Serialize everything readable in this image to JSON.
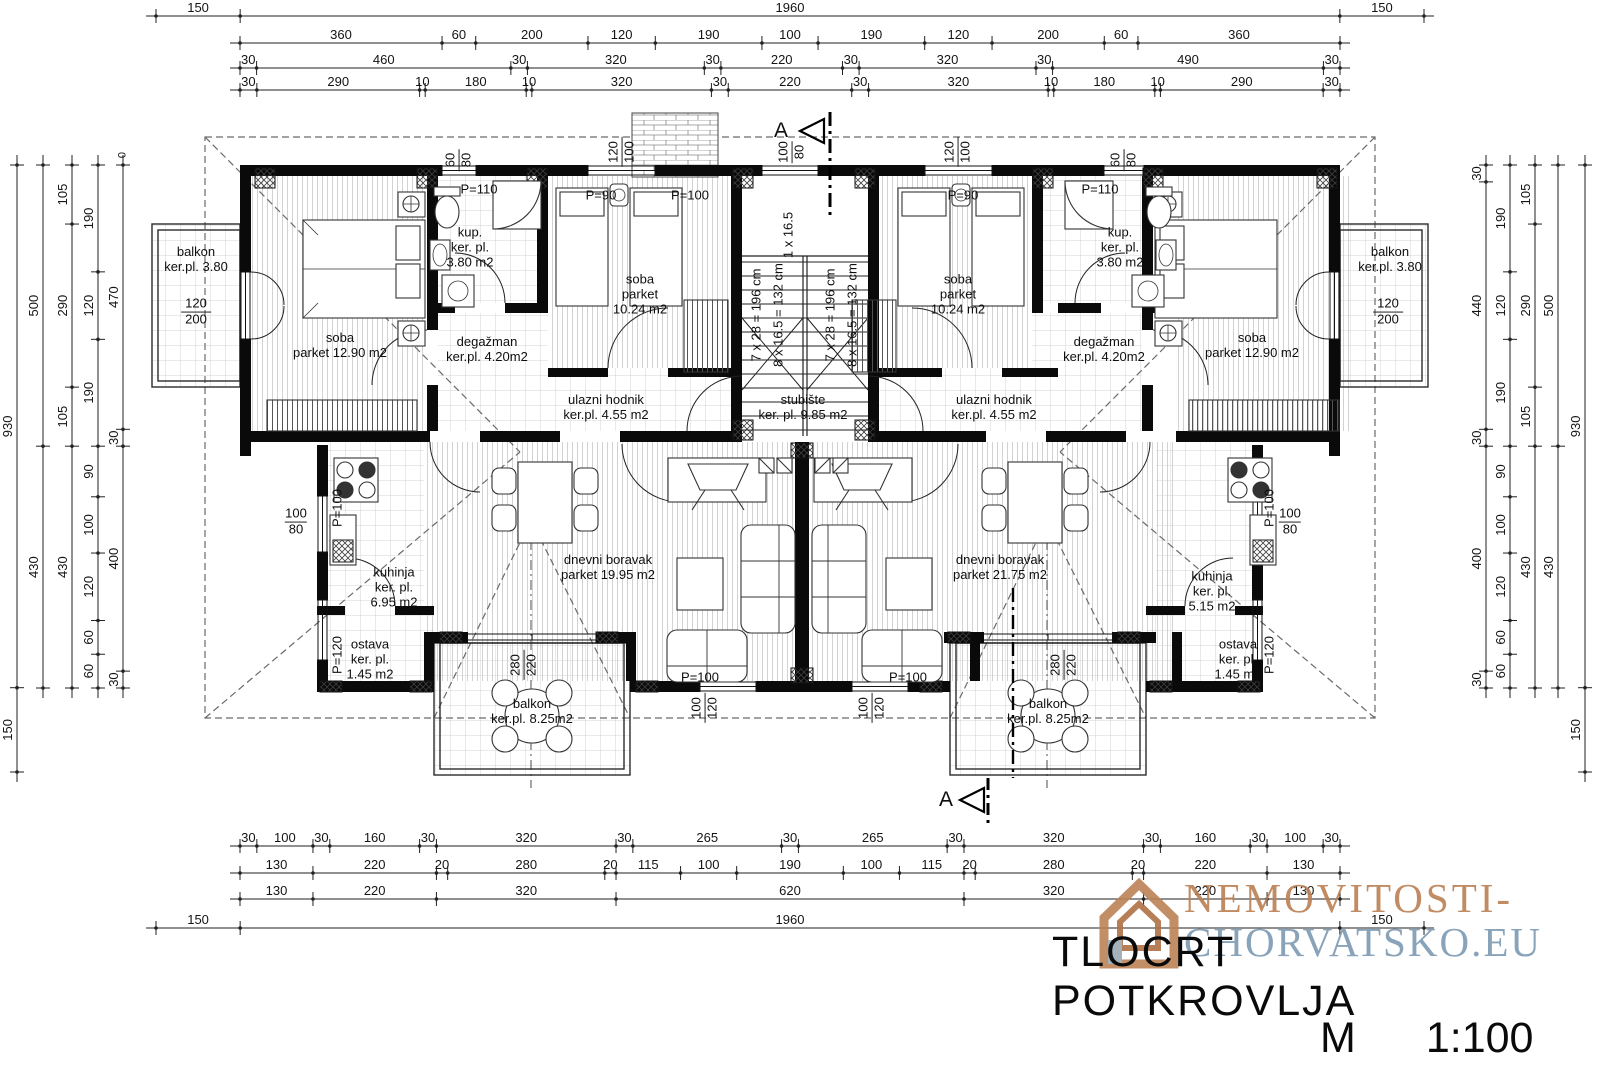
{
  "title_block": {
    "title": "TLOCRT POTKROVLJA",
    "scale_letter": "M",
    "scale_ratio": "1:100"
  },
  "watermark": {
    "line1": "NEMOVITOSTI-",
    "line2": "CHORVATSKO.EU",
    "color1": "#bc8256",
    "color2": "#7f9cb5",
    "house_icon_color": "#bc8256"
  },
  "section_marker_letter": "A",
  "datum_label": "0",
  "dims": {
    "horizontal": [
      {
        "id": "top-row-1",
        "y": 16,
        "x1": 156,
        "x2": 1424,
        "values": [
          150,
          1960,
          150
        ]
      },
      {
        "id": "top-row-2",
        "y": 43,
        "x1": 240,
        "x2": 1340,
        "values": [
          360,
          60,
          200,
          120,
          190,
          100,
          190,
          120,
          200,
          60,
          360
        ]
      },
      {
        "id": "top-row-3",
        "y": 68,
        "x1": 240,
        "x2": 1340,
        "values": [
          30,
          460,
          30,
          320,
          30,
          220,
          30,
          320,
          30,
          490,
          30
        ]
      },
      {
        "id": "top-row-4",
        "y": 90,
        "x1": 240,
        "x2": 1340,
        "values": [
          30,
          290,
          10,
          180,
          10,
          320,
          30,
          220,
          30,
          320,
          10,
          180,
          10,
          290,
          30
        ]
      },
      {
        "id": "bottom-row-1",
        "y": 846,
        "x1": 240,
        "x2": 1340,
        "values": [
          30,
          100,
          30,
          160,
          30,
          320,
          30,
          265,
          30,
          265,
          30,
          320,
          30,
          160,
          30,
          100,
          30
        ]
      },
      {
        "id": "bottom-row-2",
        "y": 873,
        "x1": 240,
        "x2": 1340,
        "values": [
          130,
          220,
          20,
          280,
          20,
          115,
          100,
          190,
          100,
          115,
          20,
          280,
          20,
          220,
          130
        ]
      },
      {
        "id": "bottom-row-3",
        "y": 899,
        "x1": 240,
        "x2": 1340,
        "values": [
          130,
          220,
          320,
          620,
          320,
          220,
          130
        ]
      },
      {
        "id": "bottom-row-4",
        "y": 928,
        "x1": 156,
        "x2": 1424,
        "values": [
          150,
          1960,
          150
        ]
      }
    ],
    "vertical": [
      {
        "id": "left-col-1",
        "x": 17,
        "y1": 165,
        "y2": 772,
        "values": [
          930,
          150
        ]
      },
      {
        "id": "left-col-2",
        "x": 43,
        "y1": 165,
        "y2": 688,
        "values": [
          500,
          430
        ]
      },
      {
        "id": "left-col-3",
        "x": 72,
        "y1": 165,
        "y2": 688,
        "values": [
          105,
          290,
          105,
          430
        ]
      },
      {
        "id": "left-col-4",
        "x": 98,
        "y1": 165,
        "y2": 688,
        "values": [
          190,
          120,
          190,
          90,
          100,
          120,
          60,
          60
        ]
      },
      {
        "id": "left-col-5",
        "x": 123,
        "y1": 165,
        "y2": 688,
        "values": [
          470,
          30,
          400,
          30
        ]
      },
      {
        "id": "right-col-1",
        "x": 1486,
        "y1": 165,
        "y2": 688,
        "values": [
          30,
          440,
          30,
          400,
          30
        ]
      },
      {
        "id": "right-col-2",
        "x": 1510,
        "y1": 165,
        "y2": 688,
        "values": [
          190,
          120,
          190,
          90,
          100,
          120,
          60,
          60
        ]
      },
      {
        "id": "right-col-3",
        "x": 1535,
        "y1": 165,
        "y2": 688,
        "values": [
          105,
          290,
          105,
          430
        ]
      },
      {
        "id": "right-col-4",
        "x": 1558,
        "y1": 165,
        "y2": 688,
        "values": [
          500,
          430
        ]
      },
      {
        "id": "right-col-5",
        "x": 1585,
        "y1": 165,
        "y2": 772,
        "values": [
          930,
          150
        ]
      }
    ]
  },
  "labels": [
    {
      "id": "room-balkon-left",
      "x": 196,
      "y": 260,
      "cls": "",
      "lines": [
        "balkon",
        "ker.pl. 3.80"
      ]
    },
    {
      "id": "room-soba-left",
      "x": 340,
      "y": 346,
      "cls": "",
      "lines": [
        "soba",
        "parket 12.90 m2"
      ]
    },
    {
      "id": "room-kup-left",
      "x": 470,
      "y": 248,
      "cls": "",
      "lines": [
        "kup.",
        "ker. pl.",
        "3.80 m2"
      ]
    },
    {
      "id": "room-degazman-left",
      "x": 487,
      "y": 350,
      "cls": "",
      "lines": [
        "degažman",
        "ker.pl. 4.20m2"
      ]
    },
    {
      "id": "room-soba-small-left",
      "x": 640,
      "y": 295,
      "cls": "",
      "lines": [
        "soba",
        "parket",
        "10.24 m2"
      ]
    },
    {
      "id": "room-ulazni-left",
      "x": 606,
      "y": 408,
      "cls": "",
      "lines": [
        "ulazni hodnik",
        "ker.pl. 4.55 m2"
      ]
    },
    {
      "id": "room-stubiste",
      "x": 803,
      "y": 408,
      "cls": "",
      "lines": [
        "stubište",
        "ker. pl. 9.85 m2"
      ]
    },
    {
      "id": "room-ulazni-right",
      "x": 994,
      "y": 408,
      "cls": "",
      "lines": [
        "ulazni hodnik",
        "ker.pl. 4.55 m2"
      ]
    },
    {
      "id": "room-soba-small-right",
      "x": 958,
      "y": 295,
      "cls": "",
      "lines": [
        "soba",
        "parket",
        "10.24 m2"
      ]
    },
    {
      "id": "room-kup-right",
      "x": 1120,
      "y": 248,
      "cls": "",
      "lines": [
        "kup.",
        "ker. pl.",
        "3.80 m2"
      ]
    },
    {
      "id": "room-degazman-right",
      "x": 1104,
      "y": 350,
      "cls": "",
      "lines": [
        "degažman",
        "ker.pl. 4.20m2"
      ]
    },
    {
      "id": "room-soba-right",
      "x": 1252,
      "y": 346,
      "cls": "",
      "lines": [
        "soba",
        "parket 12.90 m2"
      ]
    },
    {
      "id": "room-balkon-right",
      "x": 1390,
      "y": 260,
      "cls": "",
      "lines": [
        "balkon",
        "ker.pl. 3.80"
      ]
    },
    {
      "id": "room-kuhinja-left",
      "x": 394,
      "y": 588,
      "cls": "",
      "lines": [
        "kuhinja",
        "ker. pl.",
        "6.95 m2"
      ]
    },
    {
      "id": "room-ostava-left",
      "x": 370,
      "y": 660,
      "cls": "",
      "lines": [
        "ostava",
        "ker. pl.",
        "1.45 m2"
      ]
    },
    {
      "id": "room-dnevni-left",
      "x": 608,
      "y": 568,
      "cls": "",
      "lines": [
        "dnevni boravak",
        "parket 19.95 m2"
      ]
    },
    {
      "id": "room-balkon-bottom-left",
      "x": 532,
      "y": 712,
      "cls": "",
      "lines": [
        "balkon",
        "ker.pl. 8.25m2"
      ]
    },
    {
      "id": "room-dnevni-right",
      "x": 1000,
      "y": 568,
      "cls": "",
      "lines": [
        "dnevni boravak",
        "parket 21.75 m2"
      ]
    },
    {
      "id": "room-kuhinja-right",
      "x": 1212,
      "y": 592,
      "cls": "",
      "lines": [
        "kuhinja",
        "ker. pl.",
        "5.15 m2"
      ]
    },
    {
      "id": "room-ostava-right",
      "x": 1238,
      "y": 660,
      "cls": "",
      "lines": [
        "ostava",
        "ker. pl.",
        "1.45 m2"
      ]
    },
    {
      "id": "room-balkon-bottom-right",
      "x": 1048,
      "y": 712,
      "cls": "",
      "lines": [
        "balkon",
        "ker.pl. 8.25m2"
      ]
    },
    {
      "id": "window-p110-left",
      "x": 479,
      "y": 190,
      "cls": "",
      "lines": [
        "P=110"
      ]
    },
    {
      "id": "window-p90-left",
      "x": 601,
      "y": 196,
      "cls": "",
      "lines": [
        "P=90"
      ]
    },
    {
      "id": "window-p100-top",
      "x": 690,
      "y": 196,
      "cls": "",
      "lines": [
        "P=100"
      ]
    },
    {
      "id": "window-p90-right",
      "x": 963,
      "y": 196,
      "cls": "",
      "lines": [
        "P=90"
      ]
    },
    {
      "id": "window-p110-right",
      "x": 1100,
      "y": 190,
      "cls": "",
      "lines": [
        "P=110"
      ]
    },
    {
      "id": "door-p100-bottom-left",
      "x": 700,
      "y": 678,
      "cls": "",
      "lines": [
        "P=100"
      ]
    },
    {
      "id": "door-p100-bottom-right",
      "x": 908,
      "y": 678,
      "cls": "",
      "lines": [
        "P=100"
      ]
    },
    {
      "id": "datum-zero",
      "x": 123,
      "y": 155,
      "cls": "rot small",
      "lines": [
        "0"
      ]
    },
    {
      "id": "stair-first-step",
      "x": 789,
      "y": 235,
      "cls": "rot",
      "lines": [
        "1 x 16.5"
      ]
    },
    {
      "id": "stair-flight1-run",
      "x": 757,
      "y": 315,
      "cls": "rot",
      "lines": [
        "7 x 28 = 196 cm"
      ]
    },
    {
      "id": "stair-flight1-rise",
      "x": 779,
      "y": 315,
      "cls": "rot",
      "lines": [
        "8 x 16.5 = 132 cm"
      ]
    },
    {
      "id": "stair-flight2-run",
      "x": 831,
      "y": 315,
      "cls": "rot",
      "lines": [
        "7 x 28 = 196 cm"
      ]
    },
    {
      "id": "stair-flight2-rise",
      "x": 853,
      "y": 315,
      "cls": "rot",
      "lines": [
        "8 x 16.5 = 132 cm"
      ]
    },
    {
      "id": "window-pv100-left",
      "x": 338,
      "y": 508,
      "cls": "rot",
      "lines": [
        "P=100"
      ]
    },
    {
      "id": "window-pv120-left",
      "x": 338,
      "y": 655,
      "cls": "rot",
      "lines": [
        "P=120"
      ]
    },
    {
      "id": "window-pv100-right",
      "x": 1270,
      "y": 508,
      "cls": "rot",
      "lines": [
        "P=100"
      ]
    },
    {
      "id": "window-pv120-right",
      "x": 1270,
      "y": 655,
      "cls": "rot",
      "lines": [
        "P=120"
      ]
    },
    {
      "id": "balcony-door-size-left",
      "x": 196,
      "y": 312,
      "cls": "stacked",
      "lines": [
        "120",
        "200"
      ]
    },
    {
      "id": "balcony-door-size-right",
      "x": 1388,
      "y": 312,
      "cls": "stacked",
      "lines": [
        "120",
        "200"
      ]
    },
    {
      "id": "kitchen-window-size-left",
      "x": 296,
      "y": 522,
      "cls": "stacked",
      "lines": [
        "100",
        "80"
      ]
    },
    {
      "id": "kitchen-window-size-right",
      "x": 1290,
      "y": 522,
      "cls": "stacked",
      "lines": [
        "100",
        "80"
      ]
    },
    {
      "id": "vent-window-size-left",
      "x": 459,
      "y": 160,
      "cls": "stacked rot",
      "lines": [
        "60",
        "80"
      ]
    },
    {
      "id": "soba-window-size-left",
      "x": 622,
      "y": 152,
      "cls": "stacked rot",
      "lines": [
        "120",
        "100"
      ]
    },
    {
      "id": "stair-window-size",
      "x": 792,
      "y": 152,
      "cls": "stacked rot",
      "lines": [
        "100",
        "80"
      ]
    },
    {
      "id": "soba-window-size-right",
      "x": 958,
      "y": 152,
      "cls": "stacked rot",
      "lines": [
        "120",
        "100"
      ]
    },
    {
      "id": "vent-window-size-right",
      "x": 1124,
      "y": 160,
      "cls": "stacked rot",
      "lines": [
        "60",
        "80"
      ]
    },
    {
      "id": "terrace-door-size-left",
      "x": 524,
      "y": 665,
      "cls": "stacked rot",
      "lines": [
        "280",
        "220"
      ]
    },
    {
      "id": "terrace-door-size-right",
      "x": 1064,
      "y": 665,
      "cls": "stacked rot",
      "lines": [
        "280",
        "220"
      ]
    },
    {
      "id": "bottom-door-size-left",
      "x": 705,
      "y": 708,
      "cls": "stacked rot",
      "lines": [
        "100",
        "120"
      ]
    },
    {
      "id": "bottom-door-size-right",
      "x": 872,
      "y": 708,
      "cls": "stacked rot",
      "lines": [
        "100",
        "120"
      ]
    },
    {
      "id": "section-letter-top",
      "x": 781,
      "y": 131,
      "cls": "section",
      "lines": [
        "A"
      ]
    },
    {
      "id": "section-letter-bottom",
      "x": 946,
      "y": 800,
      "cls": "section",
      "lines": [
        "A"
      ]
    }
  ]
}
